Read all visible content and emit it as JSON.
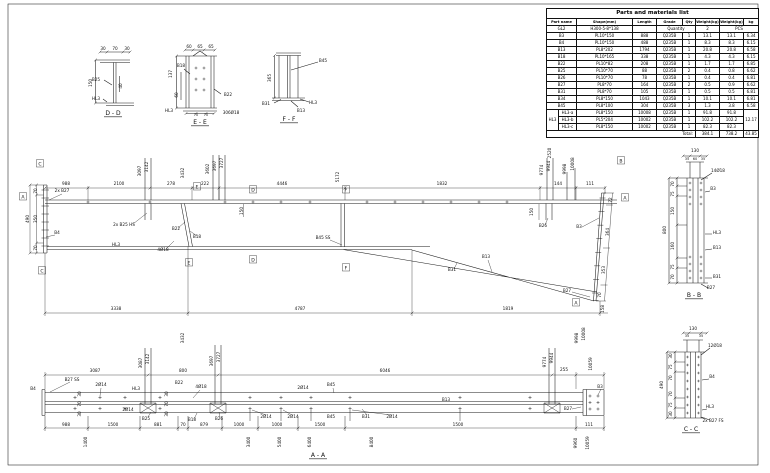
{
  "parts_table": {
    "title": "Parts and materials list",
    "headers": [
      "Part name",
      "Shape(mm)",
      "Length",
      "Grade",
      "Qty",
      "Weight(kg)",
      "Weight(kg)",
      "kg"
    ],
    "assembly_row": [
      "GL2",
      "H300-5-8*138",
      "",
      "Quantity",
      "2",
      "PCS"
    ],
    "rows": [
      [
        "B3",
        "PL10*150",
        "888",
        "Q235B",
        "1",
        "13.1",
        "13.1",
        "6.34"
      ],
      [
        "B4",
        "PL10*150",
        "488",
        "Q235B",
        "1",
        "8.3",
        "8.3",
        "6.15"
      ],
      [
        "B13",
        "PL8*202",
        "1794",
        "Q235B",
        "1",
        "20.8",
        "20.8",
        "6.58"
      ],
      [
        "B18",
        "PL10*165",
        "338",
        "Q235B",
        "1",
        "4.3",
        "4.3",
        "6.15"
      ],
      [
        "B22",
        "PL10*82",
        "208",
        "Q235B",
        "1",
        "1.7",
        "1.7",
        "6.85"
      ],
      [
        "B25",
        "PL10*70",
        "88",
        "Q235B",
        "2",
        "0.4",
        "0.8",
        "6.62"
      ],
      [
        "B26",
        "PL10*70",
        "78",
        "Q235B",
        "1",
        "0.4",
        "0.4",
        "6.81"
      ],
      [
        "B27",
        "PL8*70",
        "164",
        "Q235B",
        "2",
        "0.5",
        "0.9",
        "6.62"
      ],
      [
        "B31",
        "PL8*70",
        "105",
        "Q235B",
        "1",
        "0.5",
        "0.5",
        "6.81"
      ],
      [
        "B34",
        "PL8*150",
        "1043",
        "Q235B",
        "1",
        "10.1",
        "10.1",
        "6.81"
      ],
      [
        "B45",
        "PL8*100",
        "304",
        "Q235B",
        "3",
        "1.3",
        "3.8",
        "6.58"
      ]
    ],
    "group": {
      "name": "HL3",
      "area": "12.17",
      "rows": [
        [
          "HL3-a",
          "PL8*150",
          "10008",
          "Q235B",
          "1",
          "91.8",
          "91.8"
        ],
        [
          "HL3-b",
          "PL5*204",
          "10002",
          "Q235B",
          "1",
          "102.2",
          "102.2"
        ],
        [
          "HL3-c",
          "PL8*150",
          "10002",
          "Q235B",
          "1",
          "82.3",
          "82.3"
        ]
      ]
    },
    "total": {
      "label": "Total:",
      "unit": "384.1",
      "weight": "738.2",
      "area": "43.85"
    }
  },
  "annotations": {
    "sections_top": [
      {
        "t": "30",
        "x": 103,
        "y": 50
      },
      {
        "t": "70",
        "x": 115,
        "y": 50
      },
      {
        "t": "30",
        "x": 127,
        "y": 50
      },
      {
        "t": "150",
        "x": 92,
        "y": 83,
        "r": -90
      },
      {
        "t": "40",
        "x": 122,
        "y": 86,
        "r": -90
      },
      {
        "t": "B25",
        "x": 96,
        "y": 81
      },
      {
        "t": "HL3",
        "x": 96,
        "y": 100
      },
      {
        "t": "D - D",
        "x": 113,
        "y": 115,
        "u": 1,
        "s": 6,
        "n": "section-title-dd"
      },
      {
        "t": "60",
        "x": 189,
        "y": 48
      },
      {
        "t": "65",
        "x": 200,
        "y": 48
      },
      {
        "t": "65",
        "x": 211,
        "y": 48
      },
      {
        "t": "137",
        "x": 172,
        "y": 74,
        "r": -90
      },
      {
        "t": "60",
        "x": 178,
        "y": 95,
        "r": -90
      },
      {
        "t": "B18",
        "x": 181,
        "y": 67
      },
      {
        "t": "B22",
        "x": 228,
        "y": 96
      },
      {
        "t": "HL3",
        "x": 169,
        "y": 112
      },
      {
        "t": "70",
        "x": 196,
        "y": 116,
        "s": 3.5
      },
      {
        "t": "70",
        "x": 206,
        "y": 116,
        "s": 3.5
      },
      {
        "t": "306Ø18",
        "x": 231,
        "y": 114
      },
      {
        "t": "E - E",
        "x": 200,
        "y": 124,
        "u": 1,
        "s": 6,
        "n": "section-title-ee"
      },
      {
        "t": "B45",
        "x": 323,
        "y": 62
      },
      {
        "t": "365",
        "x": 271,
        "y": 78,
        "r": -90
      },
      {
        "t": "B31",
        "x": 266,
        "y": 105
      },
      {
        "t": "B13",
        "x": 301,
        "y": 112
      },
      {
        "t": "HL3",
        "x": 313,
        "y": 104
      },
      {
        "t": "F - F",
        "x": 289,
        "y": 121,
        "u": 1,
        "s": 6,
        "n": "section-title-ff"
      }
    ],
    "main_elevation": [
      {
        "t": "988",
        "x": 66,
        "y": 185
      },
      {
        "t": "2100",
        "x": 119,
        "y": 185
      },
      {
        "t": "278",
        "x": 171,
        "y": 185
      },
      {
        "t": "222",
        "x": 205,
        "y": 185
      },
      {
        "t": "4446",
        "x": 282,
        "y": 185
      },
      {
        "t": "1832",
        "x": 442,
        "y": 185
      },
      {
        "t": "144",
        "x": 558,
        "y": 185
      },
      {
        "t": "111",
        "x": 590,
        "y": 185
      },
      {
        "t": "3097",
        "x": 141,
        "y": 171,
        "r": -90
      },
      {
        "t": "3142",
        "x": 148,
        "y": 167,
        "r": -90
      },
      {
        "t": "3432",
        "x": 184,
        "y": 173,
        "r": -90
      },
      {
        "t": "3602",
        "x": 209,
        "y": 169,
        "r": -90
      },
      {
        "t": "3697",
        "x": 216,
        "y": 166,
        "r": -90
      },
      {
        "t": "3727",
        "x": 223,
        "y": 163,
        "r": -90
      },
      {
        "t": "2520",
        "x": 551,
        "y": 153,
        "r": -90
      },
      {
        "t": "9774",
        "x": 543,
        "y": 170,
        "r": -90
      },
      {
        "t": "9944",
        "x": 550,
        "y": 166,
        "r": -90
      },
      {
        "t": "9998",
        "x": 566,
        "y": 169,
        "r": -90
      },
      {
        "t": "10008",
        "x": 574,
        "y": 164,
        "r": -90
      },
      {
        "t": "5172",
        "x": 339,
        "y": 177,
        "r": -90
      },
      {
        "t": "70",
        "x": 37,
        "y": 191,
        "r": -90
      },
      {
        "t": "350",
        "x": 37,
        "y": 219,
        "r": -90
      },
      {
        "t": "70",
        "x": 37,
        "y": 248,
        "r": -90
      },
      {
        "t": "490",
        "x": 29,
        "y": 219,
        "r": -90
      },
      {
        "t": "72",
        "x": 612,
        "y": 200,
        "r": -90
      },
      {
        "t": "364",
        "x": 609,
        "y": 232,
        "r": -90
      },
      {
        "t": "353",
        "x": 605,
        "y": 270,
        "r": -90
      },
      {
        "t": "70",
        "x": 601,
        "y": 295,
        "r": -90
      },
      {
        "t": "3338",
        "x": 116,
        "y": 310
      },
      {
        "t": "4787",
        "x": 300,
        "y": 310
      },
      {
        "t": "1819",
        "x": 508,
        "y": 310
      },
      {
        "t": "158",
        "x": 604,
        "y": 309,
        "r": -90
      },
      {
        "t": "2x B27",
        "x": 62,
        "y": 192
      },
      {
        "t": "B4",
        "x": 57,
        "y": 234
      },
      {
        "t": "2x B25 HS",
        "x": 124,
        "y": 226
      },
      {
        "t": "B22",
        "x": 176,
        "y": 230
      },
      {
        "t": "B18",
        "x": 197,
        "y": 238
      },
      {
        "t": "HL3",
        "x": 116,
        "y": 246
      },
      {
        "t": "4Ø18",
        "x": 163,
        "y": 251
      },
      {
        "t": "B45 SS",
        "x": 323,
        "y": 239
      },
      {
        "t": "150",
        "x": 243,
        "y": 211,
        "r": -90
      },
      {
        "t": "150",
        "x": 533,
        "y": 212,
        "r": -90
      },
      {
        "t": "B26",
        "x": 543,
        "y": 227
      },
      {
        "t": "B3",
        "x": 579,
        "y": 228
      },
      {
        "t": "B13",
        "x": 486,
        "y": 258
      },
      {
        "t": "B31",
        "x": 452,
        "y": 271
      },
      {
        "t": "B27",
        "x": 567,
        "y": 292
      }
    ],
    "bottom_elevation": [
      {
        "t": "3087",
        "x": 95,
        "y": 372
      },
      {
        "t": "800",
        "x": 183,
        "y": 372
      },
      {
        "t": "6046",
        "x": 385,
        "y": 372
      },
      {
        "t": "255",
        "x": 564,
        "y": 371
      },
      {
        "t": "3087",
        "x": 142,
        "y": 363,
        "r": -90
      },
      {
        "t": "3142",
        "x": 149,
        "y": 359,
        "r": -90
      },
      {
        "t": "3432",
        "x": 184,
        "y": 338,
        "r": -90
      },
      {
        "t": "3697",
        "x": 213,
        "y": 361,
        "r": -90
      },
      {
        "t": "3727",
        "x": 220,
        "y": 357,
        "r": -90
      },
      {
        "t": "9774",
        "x": 546,
        "y": 362,
        "r": -90
      },
      {
        "t": "9944",
        "x": 553,
        "y": 358,
        "r": -90
      },
      {
        "t": "9998",
        "x": 578,
        "y": 338,
        "r": -90
      },
      {
        "t": "10008",
        "x": 585,
        "y": 334,
        "r": -90
      },
      {
        "t": "10059",
        "x": 592,
        "y": 364,
        "r": -90
      },
      {
        "t": "B4",
        "x": 33,
        "y": 390
      },
      {
        "t": "B27 SS",
        "x": 72,
        "y": 381
      },
      {
        "t": "2Ø14",
        "x": 101,
        "y": 386
      },
      {
        "t": "HL3",
        "x": 136,
        "y": 390
      },
      {
        "t": "B22",
        "x": 179,
        "y": 384
      },
      {
        "t": "4Ø18",
        "x": 201,
        "y": 388
      },
      {
        "t": "2Ø14",
        "x": 128,
        "y": 411
      },
      {
        "t": "B25",
        "x": 146,
        "y": 420
      },
      {
        "t": "B18",
        "x": 192,
        "y": 421
      },
      {
        "t": "B26",
        "x": 219,
        "y": 420
      },
      {
        "t": "30",
        "x": 81,
        "y": 394,
        "r": -90
      },
      {
        "t": "70",
        "x": 81,
        "y": 404,
        "r": -90
      },
      {
        "t": "30",
        "x": 81,
        "y": 414,
        "r": -90
      },
      {
        "t": "30",
        "x": 168,
        "y": 394,
        "r": -90
      },
      {
        "t": "70",
        "x": 168,
        "y": 404,
        "r": -90
      },
      {
        "t": "30",
        "x": 168,
        "y": 414,
        "r": -90
      },
      {
        "t": "2Ø14",
        "x": 303,
        "y": 389
      },
      {
        "t": "B45",
        "x": 331,
        "y": 386
      },
      {
        "t": "2Ø14",
        "x": 266,
        "y": 418
      },
      {
        "t": "2Ø14",
        "x": 293,
        "y": 418
      },
      {
        "t": "B45",
        "x": 331,
        "y": 418
      },
      {
        "t": "B31",
        "x": 366,
        "y": 418
      },
      {
        "t": "2Ø14",
        "x": 392,
        "y": 418
      },
      {
        "t": "B13",
        "x": 446,
        "y": 401
      },
      {
        "t": "B3",
        "x": 600,
        "y": 388
      },
      {
        "t": "B27",
        "x": 568,
        "y": 410
      },
      {
        "t": "988",
        "x": 66,
        "y": 426
      },
      {
        "t": "1500",
        "x": 113,
        "y": 426
      },
      {
        "t": "881",
        "x": 158,
        "y": 426
      },
      {
        "t": "70",
        "x": 183,
        "y": 426
      },
      {
        "t": "879",
        "x": 204,
        "y": 426
      },
      {
        "t": "1000",
        "x": 239,
        "y": 426
      },
      {
        "t": "1000",
        "x": 277,
        "y": 426
      },
      {
        "t": "1500",
        "x": 320,
        "y": 426
      },
      {
        "t": "1500",
        "x": 458,
        "y": 426
      },
      {
        "t": "111",
        "x": 589,
        "y": 426
      },
      {
        "t": "1400",
        "x": 87,
        "y": 442,
        "r": -90
      },
      {
        "t": "3400",
        "x": 250,
        "y": 442,
        "r": -90
      },
      {
        "t": "5400",
        "x": 281,
        "y": 442,
        "r": -90
      },
      {
        "t": "6400",
        "x": 311,
        "y": 442,
        "r": -90
      },
      {
        "t": "8400",
        "x": 373,
        "y": 442,
        "r": -90
      },
      {
        "t": "9960",
        "x": 577,
        "y": 443,
        "r": -90
      },
      {
        "t": "10059",
        "x": 589,
        "y": 443,
        "r": -90
      },
      {
        "t": "A - A",
        "x": 318,
        "y": 457,
        "u": 1,
        "s": 6,
        "n": "view-title-aa"
      }
    ],
    "section_bb": [
      {
        "t": "130",
        "x": 695,
        "y": 152
      },
      {
        "t": "35",
        "x": 687,
        "y": 160,
        "s": 3.5
      },
      {
        "t": "60",
        "x": 695,
        "y": 160,
        "s": 3.5
      },
      {
        "t": "35",
        "x": 703,
        "y": 160,
        "s": 3.5
      },
      {
        "t": "14Ø18",
        "x": 718,
        "y": 172
      },
      {
        "t": "B3",
        "x": 713,
        "y": 190
      },
      {
        "t": "HL3",
        "x": 717,
        "y": 234
      },
      {
        "t": "B13",
        "x": 717,
        "y": 249
      },
      {
        "t": "B31",
        "x": 717,
        "y": 278
      },
      {
        "t": "B27",
        "x": 711,
        "y": 289
      },
      {
        "t": "70",
        "x": 674,
        "y": 184,
        "r": -90
      },
      {
        "t": "75",
        "x": 674,
        "y": 194,
        "r": -90
      },
      {
        "t": "150",
        "x": 674,
        "y": 211,
        "r": -90
      },
      {
        "t": "160",
        "x": 674,
        "y": 246,
        "r": -90
      },
      {
        "t": "75",
        "x": 674,
        "y": 267,
        "r": -90
      },
      {
        "t": "70",
        "x": 674,
        "y": 277,
        "r": -90
      },
      {
        "t": "800",
        "x": 666,
        "y": 230,
        "r": -90
      },
      {
        "t": "B - B",
        "x": 694,
        "y": 297,
        "u": 1,
        "s": 6,
        "n": "section-title-bb"
      }
    ],
    "section_cc": [
      {
        "t": "130",
        "x": 693,
        "y": 330
      },
      {
        "t": "35",
        "x": 687,
        "y": 337,
        "s": 3.5
      },
      {
        "t": "35",
        "x": 701,
        "y": 337,
        "s": 3.5
      },
      {
        "t": "12Ø18",
        "x": 715,
        "y": 347
      },
      {
        "t": "B4",
        "x": 712,
        "y": 378
      },
      {
        "t": "HL3",
        "x": 710,
        "y": 408
      },
      {
        "t": "2x B27 FS",
        "x": 713,
        "y": 422
      },
      {
        "t": "30",
        "x": 672,
        "y": 356,
        "r": -90
      },
      {
        "t": "75",
        "x": 672,
        "y": 367,
        "r": -90
      },
      {
        "t": "70",
        "x": 672,
        "y": 378,
        "r": -90
      },
      {
        "t": "70",
        "x": 672,
        "y": 394,
        "r": -90
      },
      {
        "t": "75",
        "x": 672,
        "y": 405,
        "r": -90
      },
      {
        "t": "30",
        "x": 672,
        "y": 414,
        "r": -90
      },
      {
        "t": "490",
        "x": 663,
        "y": 385,
        "r": -90
      },
      {
        "t": "C - C",
        "x": 691,
        "y": 431,
        "u": 1,
        "s": 6,
        "n": "section-title-cc"
      }
    ]
  },
  "markers": [
    {
      "t": "C",
      "x": 40,
      "y": 164
    },
    {
      "t": "C",
      "x": 42,
      "y": 271
    },
    {
      "t": "A",
      "x": 23,
      "y": 197
    },
    {
      "t": "E",
      "x": 197,
      "y": 187
    },
    {
      "t": "E",
      "x": 189,
      "y": 263
    },
    {
      "t": "D",
      "x": 253,
      "y": 190
    },
    {
      "t": "D",
      "x": 253,
      "y": 260
    },
    {
      "t": "F",
      "x": 346,
      "y": 190
    },
    {
      "t": "F",
      "x": 346,
      "y": 268
    },
    {
      "t": "B",
      "x": 621,
      "y": 161
    },
    {
      "t": "A",
      "x": 625,
      "y": 198
    },
    {
      "t": "A",
      "x": 576,
      "y": 303
    }
  ]
}
